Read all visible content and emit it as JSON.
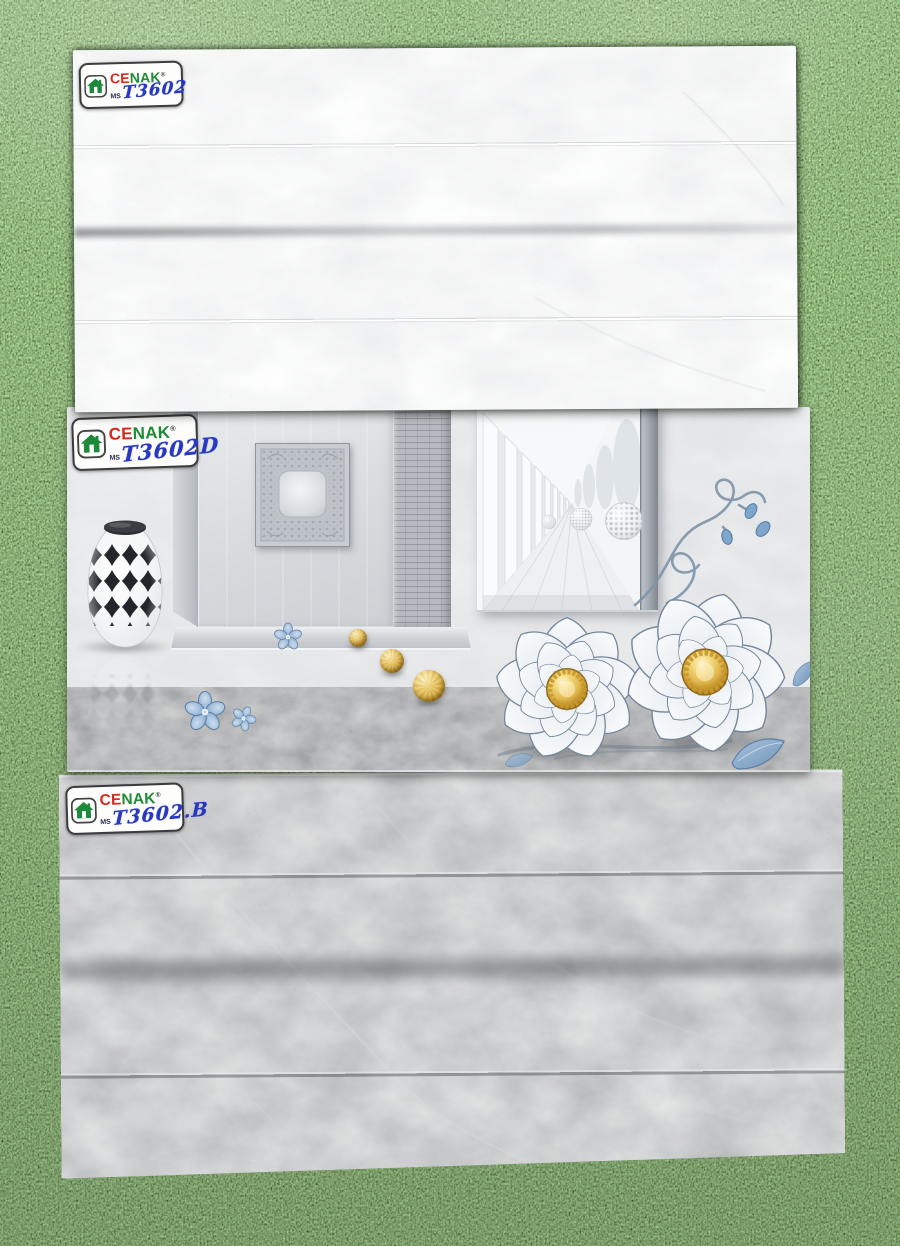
{
  "scene": {
    "type": "product-photo",
    "subject": "Three CENAK ceramic wall tiles displayed on artificial grass",
    "background": "green artificial grass",
    "tile_count": 3
  },
  "brand": {
    "name": "CENAK",
    "name_part1": "CE",
    "name_part2": "NAK",
    "reg_mark": "®",
    "prefix": "MS"
  },
  "tiles": [
    {
      "position": "top",
      "code": "T3602",
      "finish": "light grey marble, horizontal grooved bands"
    },
    {
      "position": "middle",
      "code": "T3602D",
      "finish": "decor feature tile",
      "decor_elements": [
        "white lattice vase with dark lid",
        "carved square relief medallion with pillow centre",
        "marble wall panel with pilaster strip and sill",
        "brick-textured pilaster strip",
        "3D white colonnade corridor artwork with dotted spheres",
        "three golden spheres",
        "small blue blossoms",
        "two large white flowers with golden gem centres",
        "blue curling tendrils with buds",
        "blue leaves",
        "dark grey stone skirting band"
      ]
    },
    {
      "position": "bottom",
      "code": "T3602.B",
      "finish": "dark grey marble, white veins, horizontal grooved bands"
    }
  ],
  "colors": {
    "grass_green": "#3c6a2e",
    "grass_highlight": "#7fae5f",
    "tile_light_grey": "#e6e8ea",
    "tile_mid_grey": "#d9dbde",
    "tile_dark_grey": "#8e9095",
    "skirting_grey": "#75777c",
    "gold": "#d9ad3e",
    "flower_blue": "#8fb3d6",
    "petal_white": "#eef1f4",
    "logo_red": "#d42b1e",
    "logo_green": "#1e8c34",
    "handwriting_blue": "#2839c2",
    "sticker_white": "#fdfdfb"
  }
}
